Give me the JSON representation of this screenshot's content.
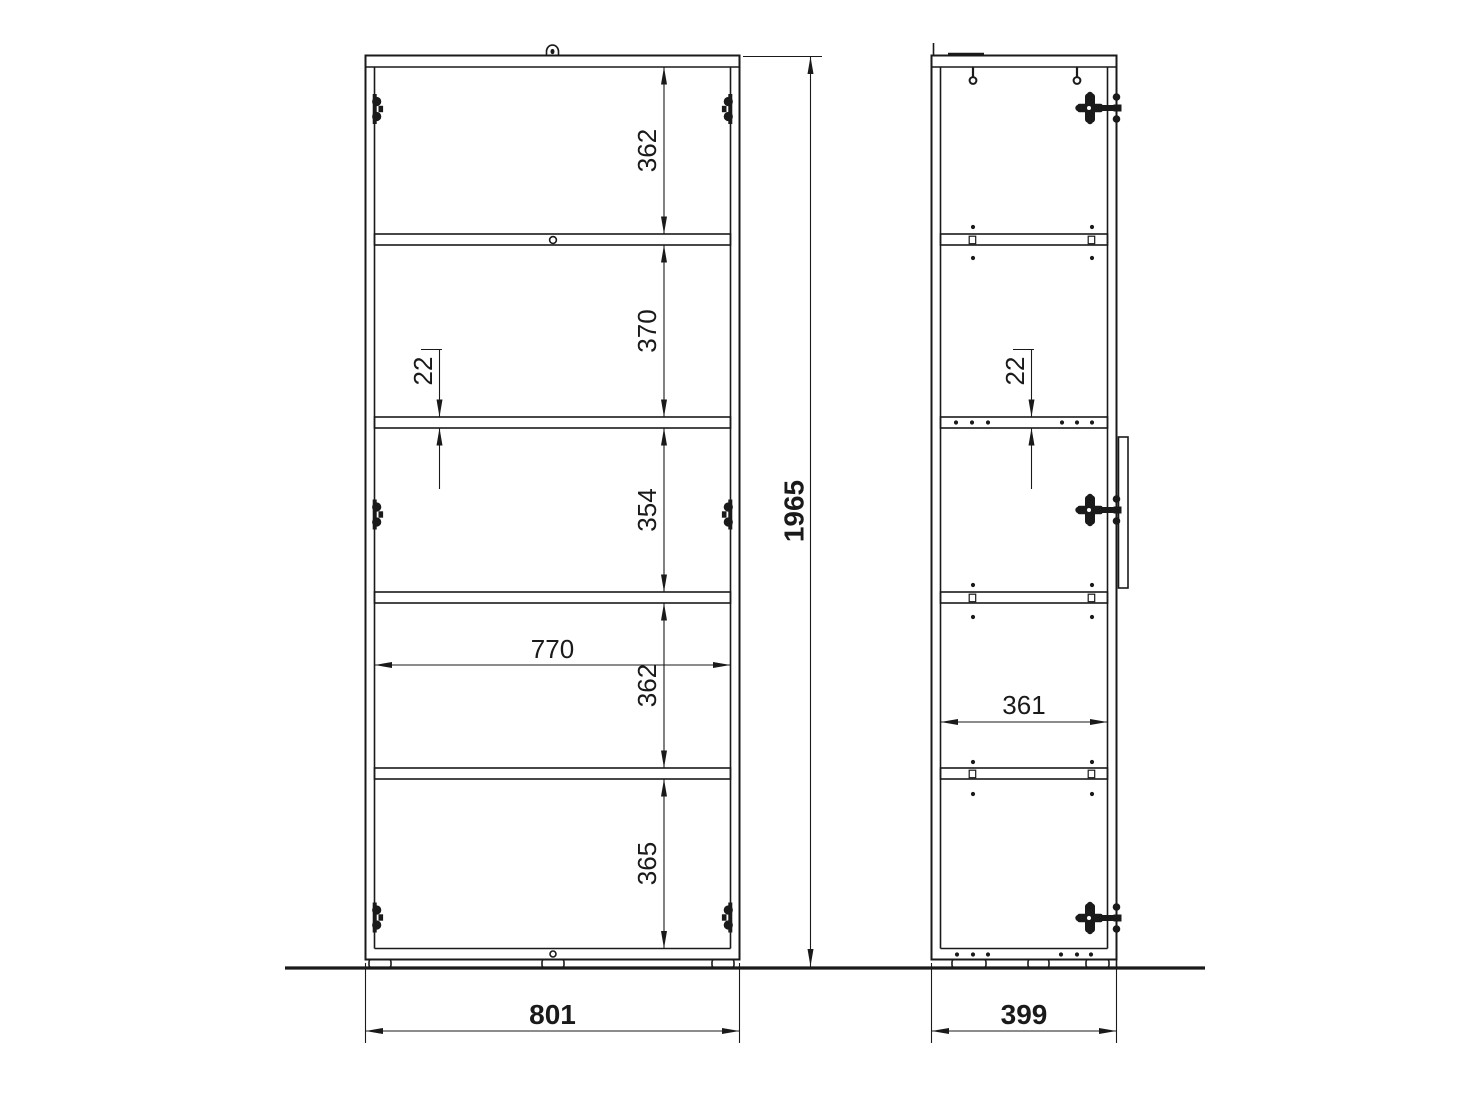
{
  "front_view": {
    "compartment_heights": [
      "362",
      "370",
      "354",
      "362",
      "365"
    ],
    "inner_width": "770",
    "shelf_thickness": "22",
    "overall_width": "801"
  },
  "side_view": {
    "shelf_thickness": "22",
    "inner_depth": "361",
    "overall_depth": "399"
  },
  "overall_height": "1965",
  "colors": {
    "line": "#1a1a1a",
    "background": "#ffffff"
  },
  "icons": {
    "hinge_icon": "black cup-hinge blob",
    "screw_icon": "hanger bolt with ring head",
    "knob_icon": "dome cap with pin",
    "door_handle_icon": "vertical handle bar profile",
    "shelf_pin_icon": "small black dot",
    "foot_icon": "rounded foot glide"
  }
}
